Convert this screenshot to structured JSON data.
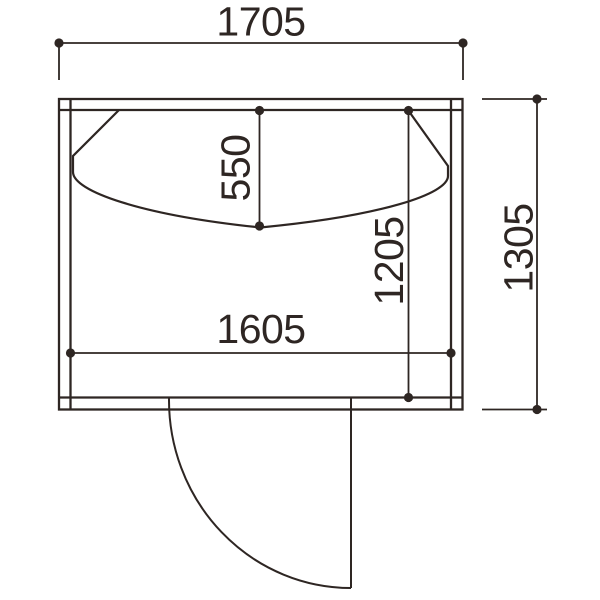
{
  "drawing": {
    "kind": "dimensioned floor plan with curved counter and door swing",
    "labels": {
      "outer_width": "1705",
      "outer_height": "1305",
      "inner_width": "1605",
      "inner_height": "1205",
      "counter_depth": "550"
    },
    "colors": {
      "line": "#2e2623",
      "background": "#ffffff"
    }
  }
}
